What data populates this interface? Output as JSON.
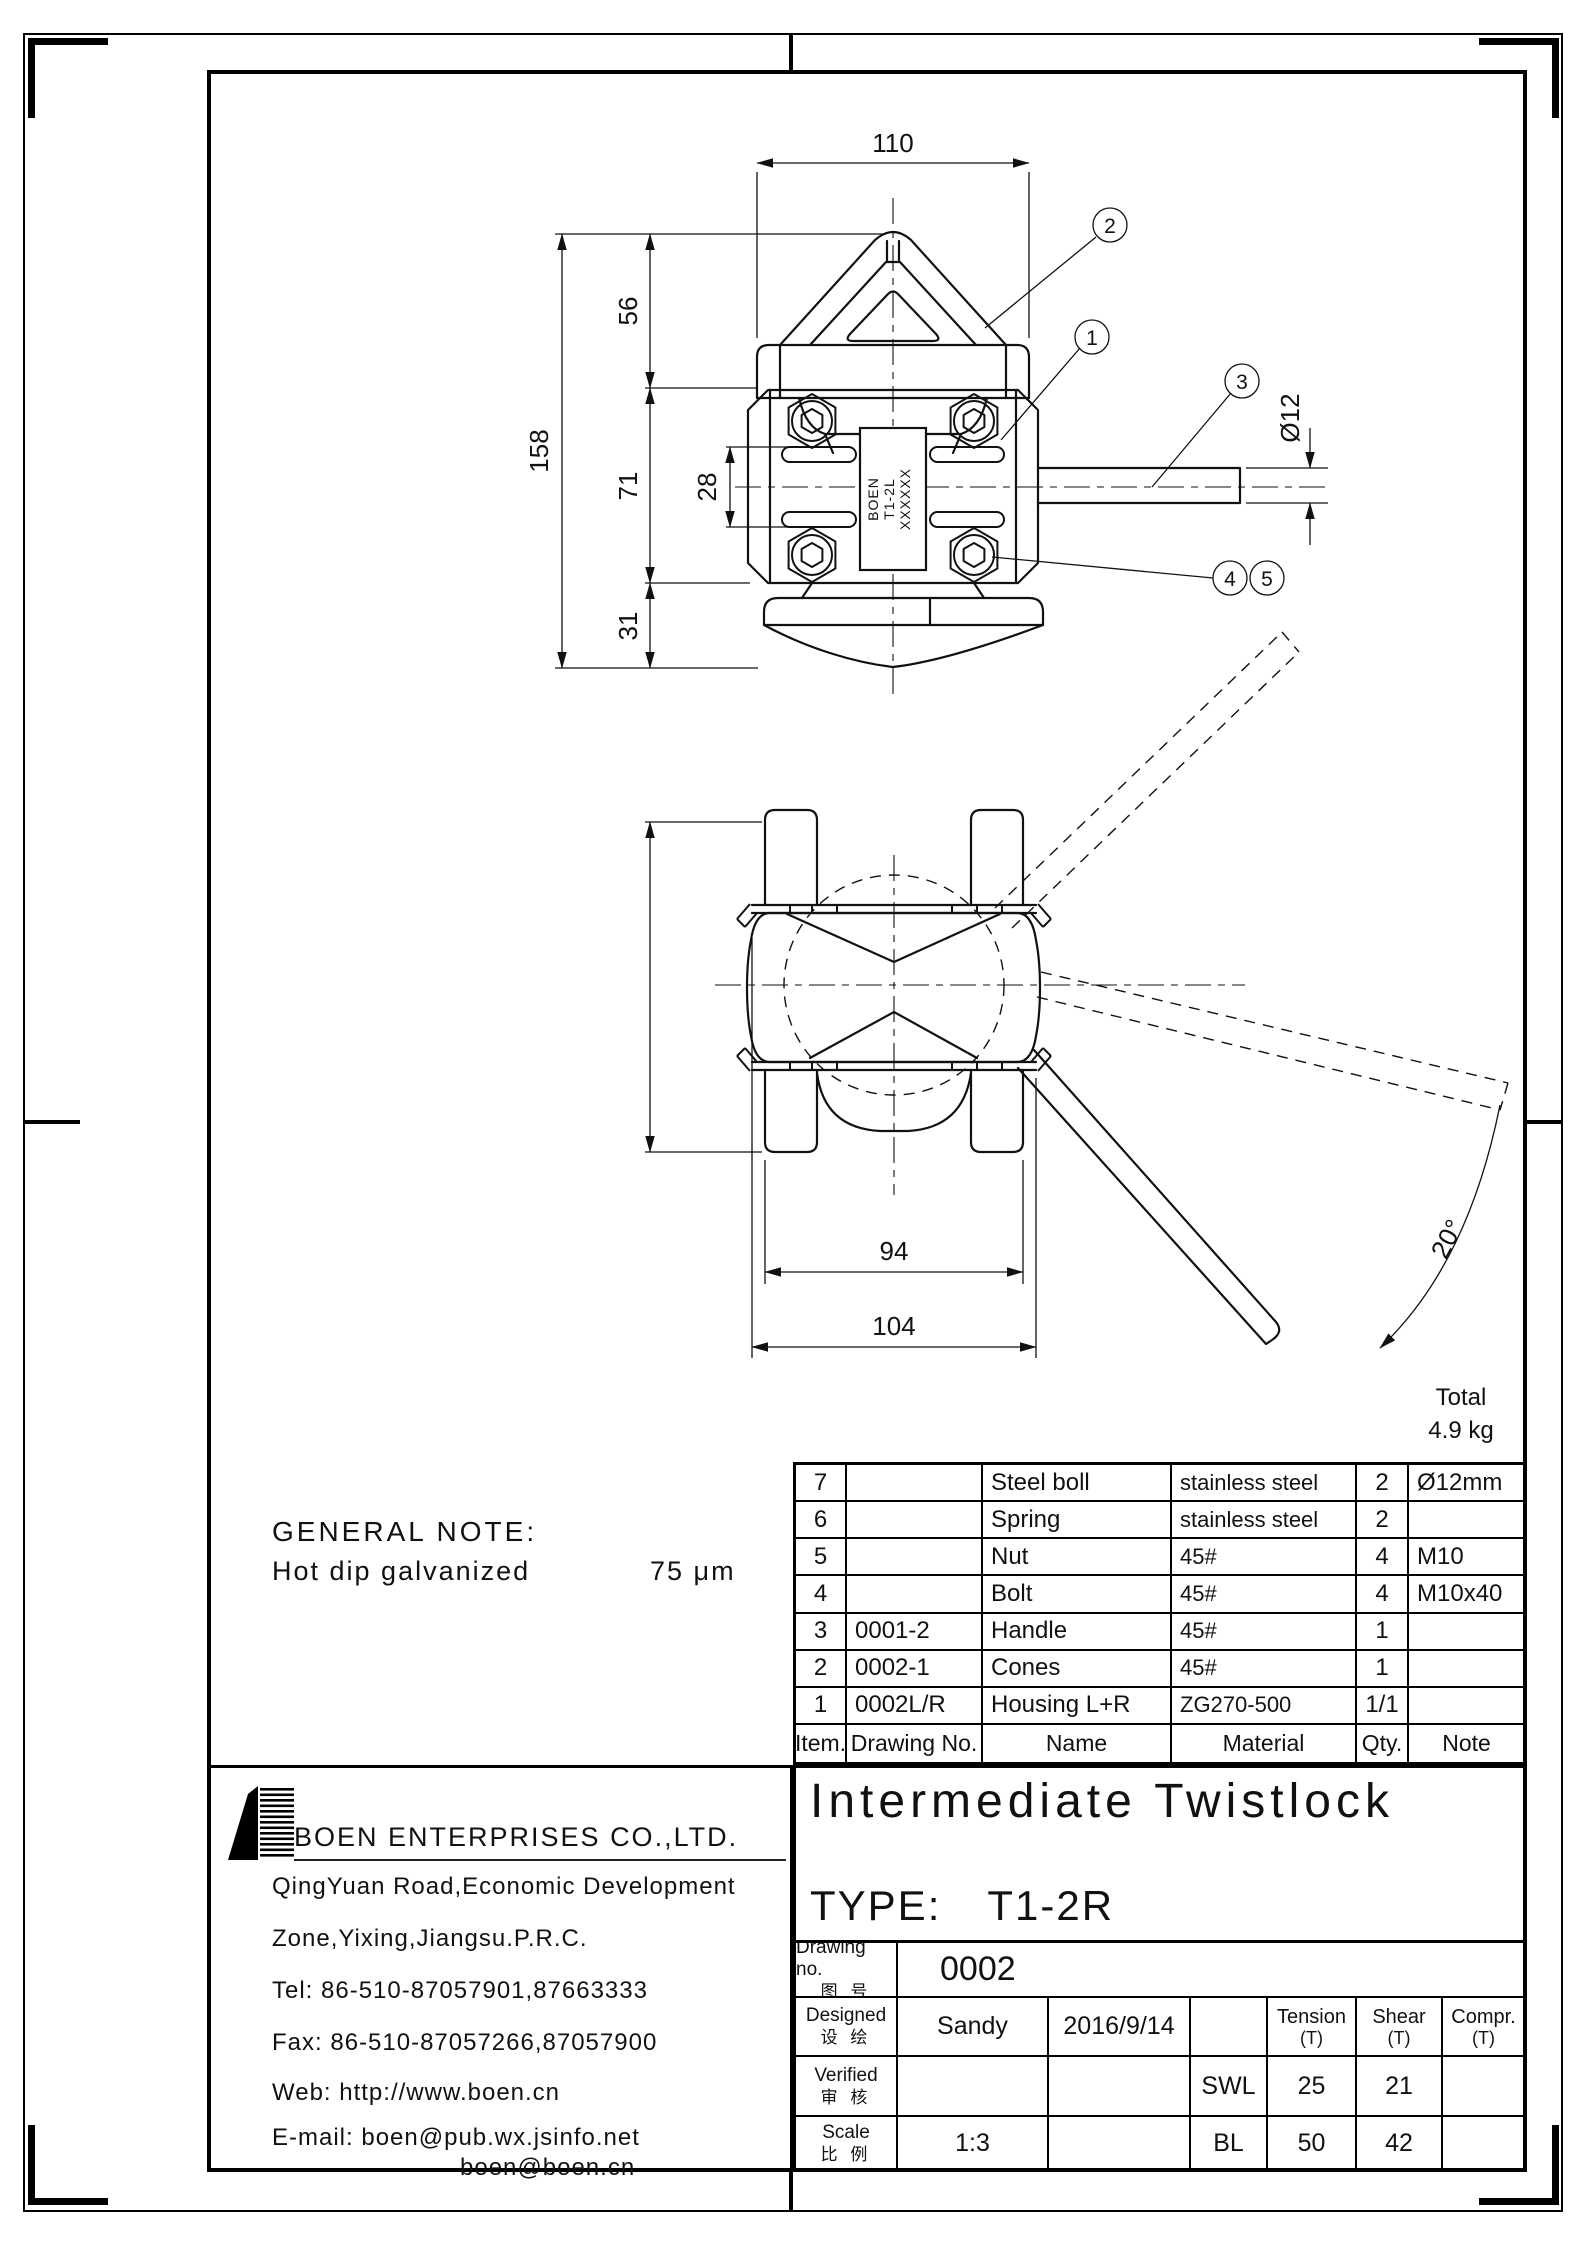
{
  "drawing": {
    "front_view": {
      "dim_110": "110",
      "dim_56": "56",
      "dim_158": "158",
      "dim_71": "71",
      "dim_28": "28",
      "dim_31": "31",
      "dim_rod_dia": "Ø12",
      "plate_line1": "BOEN",
      "plate_line2": "T1-2L",
      "plate_line3": "XXXXXX",
      "callout_1": "1",
      "callout_2": "2",
      "callout_3": "3",
      "callout_4": "4",
      "callout_5": "5"
    },
    "side_view": {
      "dim_94": "94",
      "dim_104": "104",
      "dim_angle": "20°"
    },
    "general_note": {
      "title": "GENERAL NOTE:",
      "text": "Hot dip galvanized",
      "value": "75 μm"
    },
    "total": {
      "label": "Total",
      "value": "4.9 kg"
    }
  },
  "bom": {
    "headers": {
      "item": "Item.",
      "drawing_no": "Drawing No.",
      "name": "Name",
      "material": "Material",
      "qty": "Qty.",
      "note": "Note"
    },
    "rows": [
      {
        "item": "7",
        "drawing_no": "",
        "name": "Steel boll",
        "material": "stainless steel",
        "qty": "2",
        "note": "Ø12mm"
      },
      {
        "item": "6",
        "drawing_no": "",
        "name": "Spring",
        "material": "stainless steel",
        "qty": "2",
        "note": ""
      },
      {
        "item": "5",
        "drawing_no": "",
        "name": "Nut",
        "material": "45#",
        "qty": "4",
        "note": "M10"
      },
      {
        "item": "4",
        "drawing_no": "",
        "name": "Bolt",
        "material": "45#",
        "qty": "4",
        "note": "M10x40"
      },
      {
        "item": "3",
        "drawing_no": "0001-2",
        "name": "Handle",
        "material": "45#",
        "qty": "1",
        "note": ""
      },
      {
        "item": "2",
        "drawing_no": "0002-1",
        "name": "Cones",
        "material": "45#",
        "qty": "1",
        "note": ""
      },
      {
        "item": "1",
        "drawing_no": "0002L/R",
        "name": "Housing L+R",
        "material": "ZG270-500",
        "qty": "1/1",
        "note": ""
      }
    ]
  },
  "title_block": {
    "title": "Intermediate Twistlock",
    "type_label": "TYPE:",
    "type_value": "T1-2R",
    "drawing_no_label_en": "Drawing no.",
    "drawing_no_label_zh": "图 号",
    "drawing_no_value": "0002",
    "designed_label_en": "Designed",
    "designed_label_zh": "设 绘",
    "designed_name": "Sandy",
    "designed_date": "2016/9/14",
    "verified_label_en": "Verified",
    "verified_label_zh": "审 核",
    "scale_label_en": "Scale",
    "scale_label_zh": "比 例",
    "scale_value": "1:3",
    "ratings": {
      "tension_label": "Tension",
      "shear_label": "Shear",
      "compr_label": "Compr.",
      "t_unit": "(T)",
      "swl_label": "SWL",
      "swl_tension": "25",
      "swl_shear": "21",
      "bl_label": "BL",
      "bl_tension": "50",
      "bl_shear": "42"
    }
  },
  "company": {
    "name": "BOEN ENTERPRISES CO.,LTD.",
    "address1": "QingYuan Road,Economic Development",
    "address2": "Zone,Yixing,Jiangsu.P.R.C.",
    "tel": "Tel:  86-510-87057901,87663333",
    "fax": "Fax:  86-510-87057266,87057900",
    "web": "Web:  http://www.boen.cn",
    "email": "E-mail:  boen@pub.wx.jsinfo.net",
    "email2": "boen@boen.cn"
  }
}
